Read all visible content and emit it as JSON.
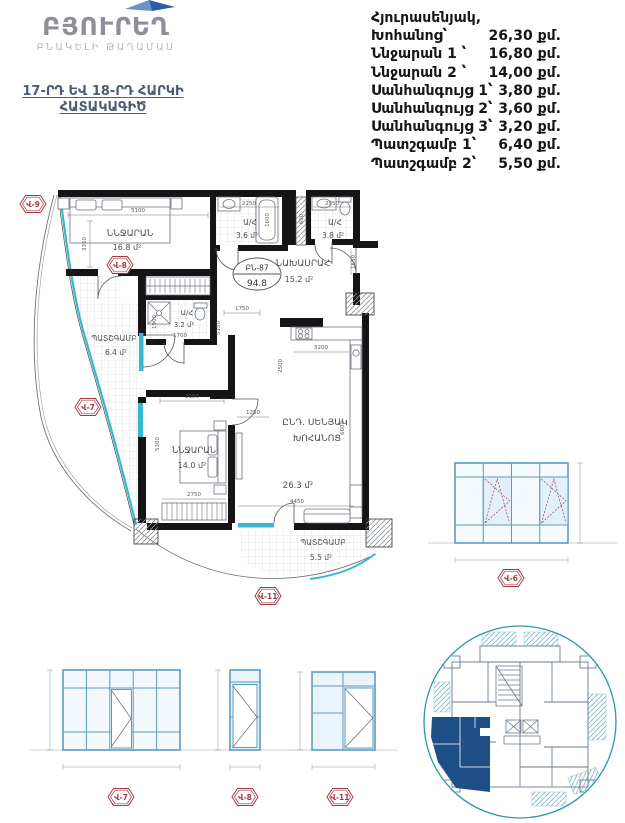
{
  "logo": {
    "title": "ԲՅՈՒՐԵՂ",
    "subtitle": "ԲՆԱԿԵԼԻ ԹԱՂԱՄԱՍ"
  },
  "page_title": {
    "line1": "17-ՐԴ ԵՎ 18-ՐԴ ՀԱՐԿԻ",
    "line2": "ՀԱՏԱԿԱԳԻԾ"
  },
  "room_list": {
    "rows": [
      {
        "label": "Հյուրասենյակ,",
        "value": ""
      },
      {
        "label": "Խոհանոց՝",
        "value": "26,30 քմ."
      },
      {
        "label": "Ննջարան 1 ՝",
        "value": "16,80 քմ."
      },
      {
        "label": "Ննջարան 2 ՝",
        "value": "14,00 քմ."
      },
      {
        "label": "Սանհանգույց 1՝",
        "value": "3,80 քմ."
      },
      {
        "label": "Սանհանգույց 2՝",
        "value": "3,60 քմ."
      },
      {
        "label": "Սանհանգույց 3՝",
        "value": "3,20 քմ."
      },
      {
        "label": "Պատշգամբ 1՝",
        "value": "6,40 քմ."
      },
      {
        "label": "Պատշգամբ 2՝",
        "value": "5,50 քմ."
      }
    ]
  },
  "plan": {
    "unit_badge": {
      "id": "ԲՆ-87",
      "total_area": "94.8"
    },
    "rooms": {
      "bedroom1": {
        "name": "ՆՆՋԱՐԱՆ",
        "area": "16.8 մ²"
      },
      "bath1": {
        "name": "Ա/Հ",
        "area": "3.6 մ²"
      },
      "bath2": {
        "name": "Ա/Հ",
        "area": "3.8 մ²"
      },
      "hall": {
        "name": "ՆԱԽԱՍՐԱՀ",
        "area": "15.2 մ²"
      },
      "bath3": {
        "name": "Ա/Հ",
        "area": "3.2 մ²"
      },
      "balcony1": {
        "name": "ՊԱՏՇԳԱՄԲ",
        "area": "6.4 մ²"
      },
      "bedroom2": {
        "name": "ՆՆՋԱՐԱՆ",
        "area": "14.0 մ²"
      },
      "living": {
        "name": "ԸՆԴ. ՍԵՆՅԱԿ",
        "name2": "ԽՈՀԱՆՈՑ",
        "area": "26.3 մ²"
      },
      "balcony2": {
        "name": "ՊԱՏՇԳԱՄԲ",
        "area": "5.5 մ²"
      }
    },
    "markers": {
      "v9": "Վ-9",
      "v8": "Վ-8",
      "v7": "Վ-7",
      "v11": "Վ-11"
    },
    "dims": {
      "d5100": "5100",
      "d3350": "3350",
      "d2250": "2250",
      "d1600": "1600",
      "d2950": "2950",
      "d600": "600",
      "d1650": "1650",
      "d1750": "1750",
      "d5150": "5150",
      "d1900": "1900",
      "d1700": "1700",
      "d2150": "2150",
      "d5300": "5300",
      "d1250": "1250",
      "d3200": "3200",
      "d2500": "2500",
      "d6600": "6600",
      "d2750": "2750",
      "d4450": "4450"
    }
  },
  "window_elevations": {
    "w7": "Վ-7",
    "w8": "Վ-8",
    "w11": "Վ-11",
    "w6": "Վ-6"
  },
  "colors": {
    "glass_cyan": "#38b8cf",
    "marker_red": "#a03a40",
    "wall_black": "#151515",
    "window_frame": "#5b9bc0",
    "keyplan_circle": "#2e96ad",
    "keyplan_unit_blue": "#1d4f86",
    "brand_blue": "#2b5ea7",
    "title_slate": "#4d5c74"
  }
}
